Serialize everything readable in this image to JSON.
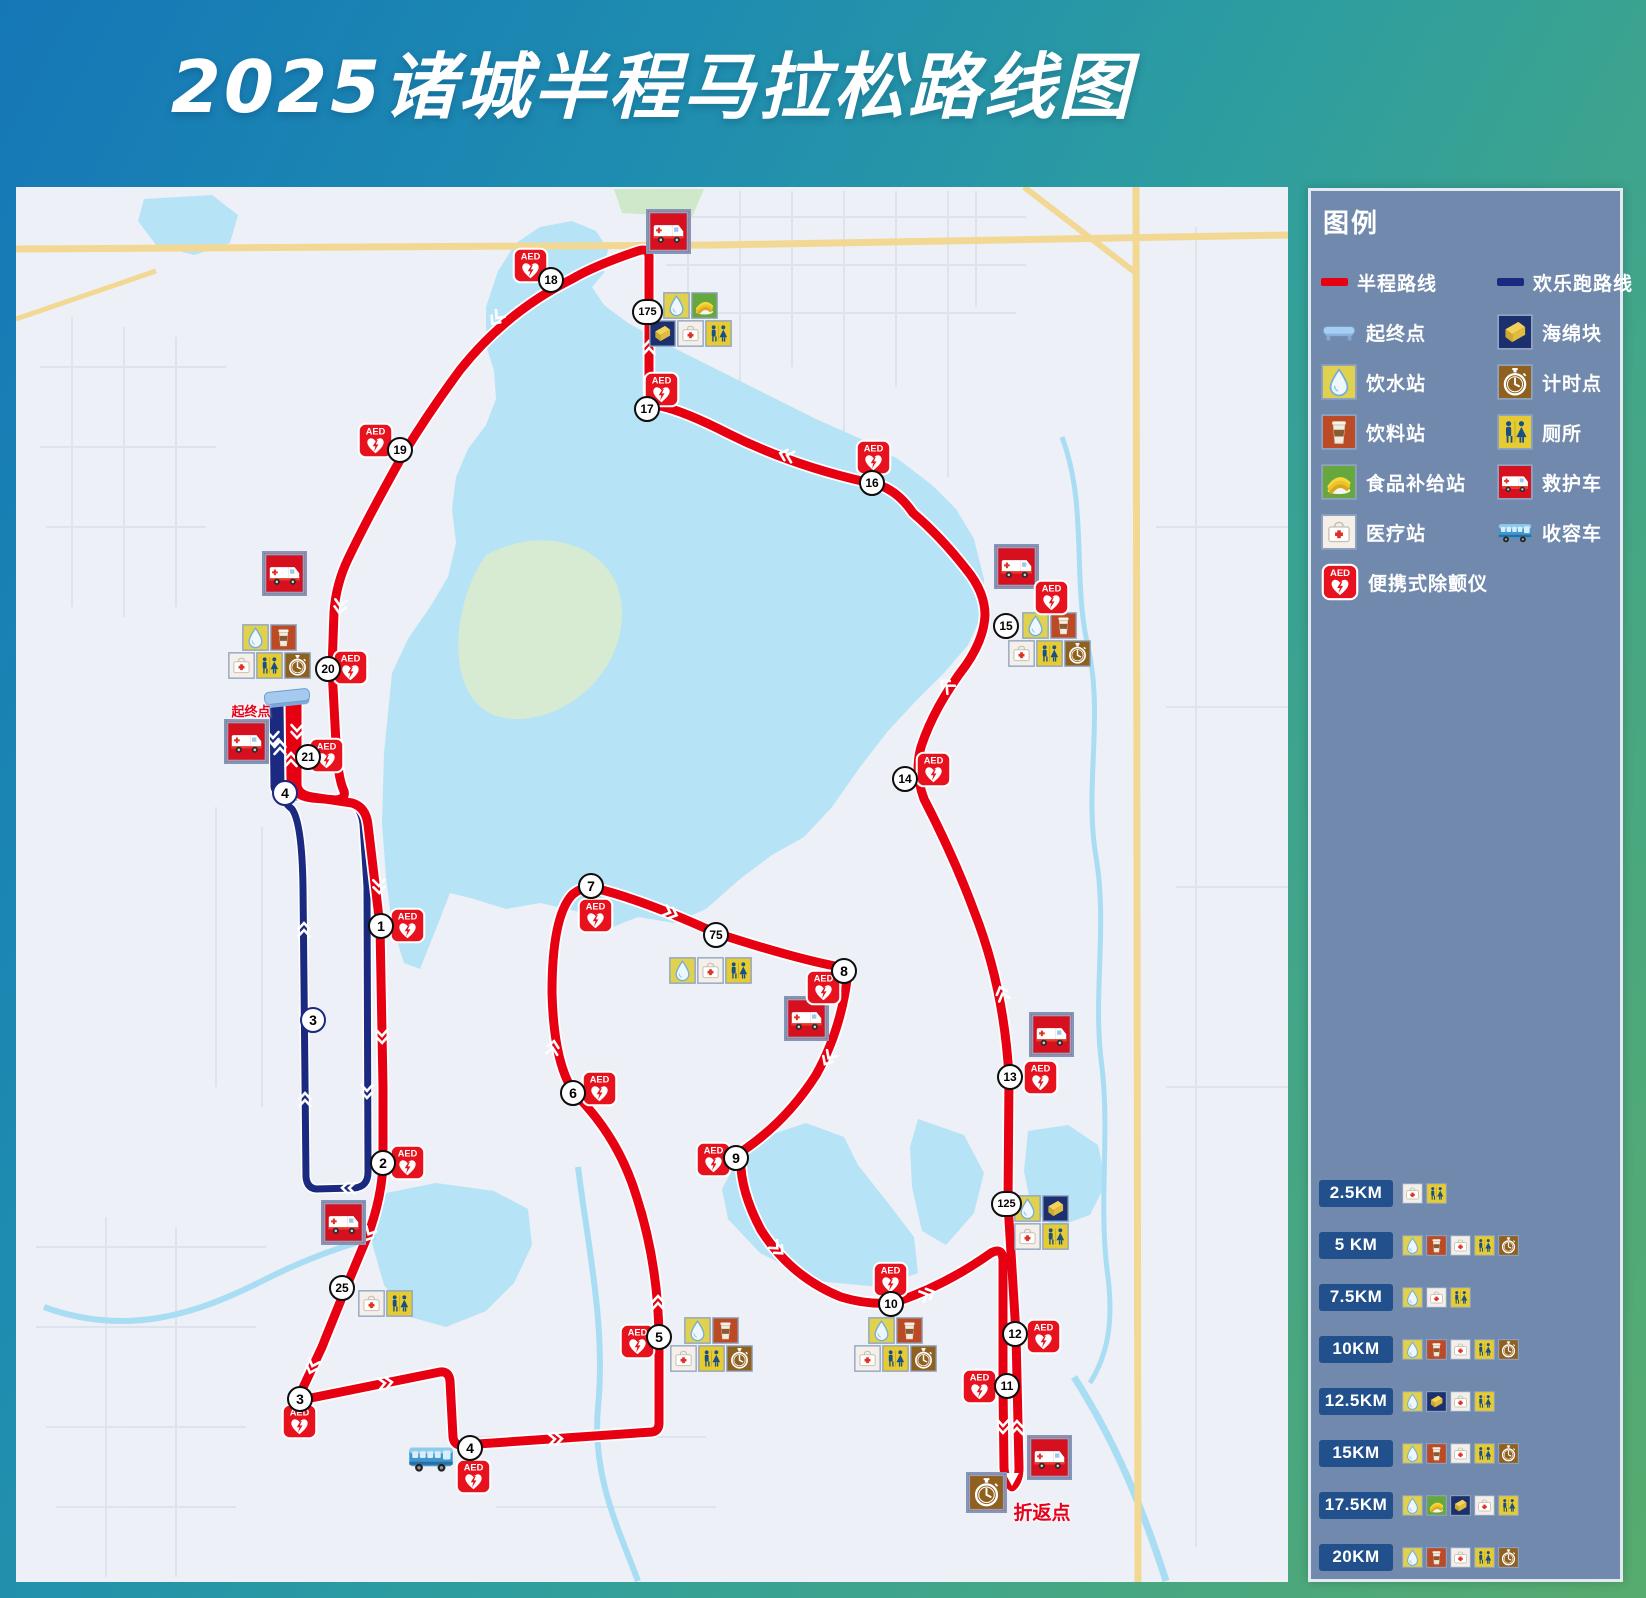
{
  "title": "2025诸城半程马拉松路线图",
  "colors": {
    "half_route": "#e60012",
    "fun_route": "#1b2a80",
    "panel_bg": "#7189ad",
    "distance_chip": "#21508d",
    "water": "#b7e3f7",
    "label_red": "#e8001a"
  },
  "legend": {
    "title": "图例",
    "routes": [
      {
        "label": "半程路线",
        "color": "#e60012"
      },
      {
        "label": "欢乐跑路线",
        "color": "#1b2a80"
      }
    ],
    "items": [
      {
        "icon": "start-finish",
        "label": "起终点"
      },
      {
        "icon": "sponge",
        "label": "海绵块"
      },
      {
        "icon": "water",
        "label": "饮水站"
      },
      {
        "icon": "timing",
        "label": "计时点"
      },
      {
        "icon": "beverage",
        "label": "饮料站"
      },
      {
        "icon": "toilet",
        "label": "厕所"
      },
      {
        "icon": "food",
        "label": "食品补给站"
      },
      {
        "icon": "ambulance",
        "label": "救护车"
      },
      {
        "icon": "medical",
        "label": "医疗站"
      },
      {
        "icon": "bus",
        "label": "收容车"
      },
      {
        "icon": "aed",
        "label": "便携式除颤仪"
      }
    ]
  },
  "distance_rows": [
    {
      "label": "2.5KM",
      "icons": [
        "medical",
        "toilet"
      ]
    },
    {
      "label": "5 KM",
      "icons": [
        "water",
        "beverage",
        "medical",
        "toilet",
        "timing"
      ]
    },
    {
      "label": "7.5KM",
      "icons": [
        "water",
        "medical",
        "toilet"
      ]
    },
    {
      "label": "10KM",
      "icons": [
        "water",
        "beverage",
        "medical",
        "toilet",
        "timing"
      ]
    },
    {
      "label": "12.5KM",
      "icons": [
        "water",
        "sponge",
        "medical",
        "toilet"
      ]
    },
    {
      "label": "15KM",
      "icons": [
        "water",
        "beverage",
        "medical",
        "toilet",
        "timing"
      ]
    },
    {
      "label": "17.5KM",
      "icons": [
        "water",
        "food",
        "sponge",
        "medical",
        "toilet"
      ]
    },
    {
      "label": "20KM",
      "icons": [
        "water",
        "beverage",
        "medical",
        "toilet",
        "timing"
      ]
    }
  ],
  "map": {
    "labels": [
      {
        "text": "起终点",
        "x": 235,
        "y": 520,
        "size": 13
      },
      {
        "text": "折返点",
        "x": 1026,
        "y": 1320,
        "size": 19
      }
    ],
    "start_finish": {
      "x": 248,
      "y": 503,
      "w": 44,
      "h": 11
    },
    "km_markers": [
      {
        "label": "1",
        "x": 365,
        "y": 739,
        "type": "half"
      },
      {
        "label": "2",
        "x": 367,
        "y": 976,
        "type": "half"
      },
      {
        "label": "25",
        "x": 326,
        "y": 1101,
        "type": "half"
      },
      {
        "label": "3",
        "x": 284,
        "y": 1212,
        "type": "half"
      },
      {
        "label": "4",
        "x": 454,
        "y": 1261,
        "type": "half"
      },
      {
        "label": "5",
        "x": 643,
        "y": 1150,
        "type": "half"
      },
      {
        "label": "6",
        "x": 557,
        "y": 906,
        "type": "half"
      },
      {
        "label": "7",
        "x": 575,
        "y": 699,
        "type": "half"
      },
      {
        "label": "75",
        "x": 700,
        "y": 748,
        "type": "half"
      },
      {
        "label": "8",
        "x": 828,
        "y": 784,
        "type": "half"
      },
      {
        "label": "9",
        "x": 720,
        "y": 971,
        "type": "half"
      },
      {
        "label": "10",
        "x": 875,
        "y": 1117,
        "type": "half"
      },
      {
        "label": "11",
        "x": 991,
        "y": 1199,
        "type": "half"
      },
      {
        "label": "12",
        "x": 999,
        "y": 1147,
        "type": "half"
      },
      {
        "label": "125",
        "x": 990,
        "y": 1017,
        "type": "half"
      },
      {
        "label": "13",
        "x": 994,
        "y": 890,
        "type": "half"
      },
      {
        "label": "14",
        "x": 889,
        "y": 592,
        "type": "half"
      },
      {
        "label": "15",
        "x": 990,
        "y": 439,
        "type": "half"
      },
      {
        "label": "16",
        "x": 856,
        "y": 296,
        "type": "half"
      },
      {
        "label": "17",
        "x": 631,
        "y": 222,
        "type": "half"
      },
      {
        "label": "175",
        "x": 631,
        "y": 125,
        "type": "half"
      },
      {
        "label": "18",
        "x": 535,
        "y": 93,
        "type": "half"
      },
      {
        "label": "19",
        "x": 384,
        "y": 263,
        "type": "half"
      },
      {
        "label": "20",
        "x": 312,
        "y": 482,
        "type": "half"
      },
      {
        "label": "21",
        "x": 292,
        "y": 570,
        "type": "half"
      },
      {
        "label": "3",
        "x": 297,
        "y": 833,
        "type": "fun"
      },
      {
        "label": "4",
        "x": 269,
        "y": 606,
        "type": "fun"
      }
    ],
    "aeds": [
      {
        "x": 514,
        "y": 79
      },
      {
        "x": 645,
        "y": 203
      },
      {
        "x": 359,
        "y": 254
      },
      {
        "x": 857,
        "y": 271
      },
      {
        "x": 1035,
        "y": 411
      },
      {
        "x": 917,
        "y": 583
      },
      {
        "x": 391,
        "y": 739
      },
      {
        "x": 391,
        "y": 976
      },
      {
        "x": 283,
        "y": 1235
      },
      {
        "x": 457,
        "y": 1290
      },
      {
        "x": 621,
        "y": 1155
      },
      {
        "x": 583,
        "y": 902
      },
      {
        "x": 579,
        "y": 729
      },
      {
        "x": 807,
        "y": 801
      },
      {
        "x": 697,
        "y": 973
      },
      {
        "x": 874,
        "y": 1093
      },
      {
        "x": 963,
        "y": 1200
      },
      {
        "x": 1027,
        "y": 1150
      },
      {
        "x": 1024,
        "y": 891
      },
      {
        "x": 334,
        "y": 481
      },
      {
        "x": 310,
        "y": 569
      }
    ],
    "ambulances": [
      {
        "x": 653,
        "y": 45
      },
      {
        "x": 269,
        "y": 387
      },
      {
        "x": 231,
        "y": 555
      },
      {
        "x": 328,
        "y": 1036
      },
      {
        "x": 791,
        "y": 832
      },
      {
        "x": 1001,
        "y": 380
      },
      {
        "x": 1036,
        "y": 848
      },
      {
        "x": 1034,
        "y": 1271
      }
    ],
    "buses": [
      {
        "x": 415,
        "y": 1271
      }
    ],
    "timing_points": [
      {
        "x": 971,
        "y": 1306
      }
    ],
    "clusters": [
      {
        "cx": 254,
        "y": 451,
        "rows": [
          [
            "water",
            "beverage"
          ],
          [
            "medical",
            "toilet",
            "timing"
          ]
        ]
      },
      {
        "cx": 696,
        "y": 1144,
        "rows": [
          [
            "water",
            "beverage"
          ],
          [
            "medical",
            "toilet",
            "timing"
          ]
        ]
      },
      {
        "cx": 880,
        "y": 1144,
        "rows": [
          [
            "water",
            "beverage"
          ],
          [
            "medical",
            "toilet",
            "timing"
          ]
        ]
      },
      {
        "cx": 1026,
        "y": 1022,
        "rows": [
          [
            "water",
            "sponge"
          ],
          [
            "medical",
            "toilet"
          ]
        ]
      },
      {
        "cx": 1034,
        "y": 439,
        "rows": [
          [
            "water",
            "beverage"
          ],
          [
            "medical",
            "toilet",
            "timing"
          ]
        ]
      },
      {
        "cx": 675,
        "y": 119,
        "rows": [
          [
            "water",
            "food"
          ],
          [
            "sponge",
            "medical",
            "toilet"
          ]
        ]
      },
      {
        "cx": 695,
        "y": 784,
        "rows": [
          [
            "water",
            "medical",
            "toilet"
          ]
        ]
      },
      {
        "cx": 370,
        "y": 1117,
        "rows": [
          [
            "medical",
            "toilet"
          ]
        ]
      }
    ],
    "routes": {
      "half_path": "M 281,514 L 281,598 Q 282,608 296,610 L 336,616 Q 350,620 352,638 L 357,680 L 364,739 L 367,900 L 367,976 Q 366,1010 352,1048 Q 332,1095 306,1160 L 285,1205 Q 281,1213 290,1212 L 424,1185 Q 433,1184 434,1194 L 437,1250 Q 438,1259 447,1258 L 636,1245 Q 643,1244 643,1236 L 643,1150 Q 642,1075 620,1008 Q 602,950 560,908 Q 538,880 536,806 Q 536,730 556,708 Q 566,699 578,701 Q 625,712 700,746 Q 780,772 824,780 Q 833,782 831,793 Q 824,845 800,888 Q 770,935 725,965 Q 722,1000 745,1043 Q 775,1090 825,1110 Q 855,1119 880,1115 Q 930,1098 975,1066 Q 986,1060 987,1072 L 987,1199 L 988,1281 Q 989,1294 996,1300 Q 1003,1294 1003,1281 L 1000,1147 L 992,1017 L 993,890 Q 988,800 958,724 Q 938,670 908,612 Q 898,585 905,560 Q 918,520 950,478 Q 968,452 969,428 Q 969,405 950,382 Q 925,350 897,326 Q 878,298 850,295 Q 775,278 713,247 Q 668,224 644,219 Q 633,216 633,204 L 633,125 L 633,72 Q 634,60 622,64 Q 580,78 556,92 Q 490,125 444,183 Q 413,225 388,266 Q 352,330 332,372 Q 320,397 318,425 L 316,482 L 320,556 Q 322,592 328,604 Q 330,612 320,613 L 296,611 Q 276,609 275,592 L 274,514",
      "fun_path": "M 257,514 L 258,600 Q 259,607 273,609 L 332,615 Q 345,619 347,637 L 351,700 L 352,985 Q 352,1000 338,1001 L 300,1002 Q 291,1001 290,990 L 287,700 Q 286,636 276,622 Q 266,614 265,604 L 264,514"
    },
    "arrows": {
      "half": [
        {
          "x": 281,
          "y": 545,
          "a": 90
        },
        {
          "x": 363,
          "y": 700,
          "a": 88
        },
        {
          "x": 366,
          "y": 850,
          "a": 89
        },
        {
          "x": 352,
          "y": 1048,
          "a": 118
        },
        {
          "x": 296,
          "y": 1180,
          "a": 110
        },
        {
          "x": 370,
          "y": 1196,
          "a": -8
        },
        {
          "x": 540,
          "y": 1252,
          "a": -4
        },
        {
          "x": 642,
          "y": 1115,
          "a": -90
        },
        {
          "x": 537,
          "y": 860,
          "a": -80
        },
        {
          "x": 655,
          "y": 726,
          "a": 22
        },
        {
          "x": 812,
          "y": 872,
          "a": 122
        },
        {
          "x": 762,
          "y": 1062,
          "a": 46
        },
        {
          "x": 912,
          "y": 1107,
          "a": -22
        },
        {
          "x": 987,
          "y": 1240,
          "a": 90
        },
        {
          "x": 1001,
          "y": 1240,
          "a": -90
        },
        {
          "x": 986,
          "y": 806,
          "a": -110
        },
        {
          "x": 930,
          "y": 498,
          "a": -137
        },
        {
          "x": 770,
          "y": 268,
          "a": -163
        },
        {
          "x": 633,
          "y": 160,
          "a": -90
        },
        {
          "x": 480,
          "y": 132,
          "a": 128
        },
        {
          "x": 324,
          "y": 420,
          "a": 97
        },
        {
          "x": 275,
          "y": 572,
          "a": -90
        }
      ],
      "fun": [
        {
          "x": 257,
          "y": 552,
          "a": 90
        },
        {
          "x": 351,
          "y": 905,
          "a": 90
        },
        {
          "x": 332,
          "y": 1001,
          "a": 182
        },
        {
          "x": 289,
          "y": 912,
          "a": -90
        },
        {
          "x": 288,
          "y": 742,
          "a": -90
        },
        {
          "x": 264,
          "y": 560,
          "a": -90
        }
      ]
    }
  }
}
